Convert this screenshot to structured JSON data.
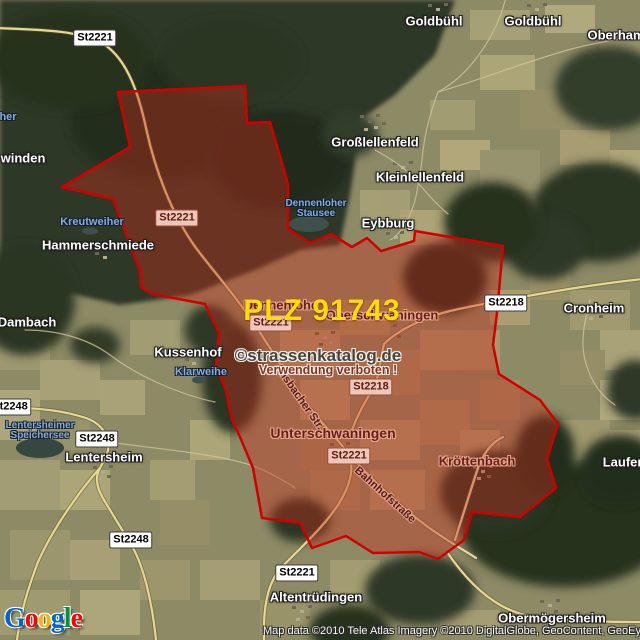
{
  "overlay": {
    "plz_text": "PLZ 91743"
  },
  "watermark": {
    "line1": "©strassenkatalog.de",
    "line2": "Verwendung verboten !"
  },
  "attribution": {
    "text": "Map data ©2010 Tele Atlas  Imagery ©2010 DigitalGlobe, GeoContent, GeoEye"
  },
  "logo": {
    "name": "Google",
    "letters": [
      "G",
      "o",
      "o",
      "g",
      "l",
      "e"
    ]
  },
  "colors": {
    "plz_text": "#FFDE00",
    "region_border": "#D10000",
    "region_fill": "rgba(200,45,28,0.40)",
    "shield_pink_bg": "#F0C6BA",
    "water_label": "#85ABDC",
    "google_blue": "#0266C8",
    "google_red": "#F90101",
    "google_yellow": "#F2B50F",
    "google_green": "#00933B"
  },
  "labels": {
    "towns": [
      {
        "text": "Goldbühl"
      },
      {
        "text": "Goldbühl"
      },
      {
        "text": "Oberhamb"
      },
      {
        "text": "winden"
      },
      {
        "text": "Großlellenfeld"
      },
      {
        "text": "Kleinlellenfeld"
      },
      {
        "text": "Eybburg"
      },
      {
        "text": "Hammerschmiede"
      },
      {
        "text": "Dambach"
      },
      {
        "text": "Kussenhof"
      },
      {
        "text": "Lentersheim"
      },
      {
        "text": "Cronheim"
      },
      {
        "text": "Laufenb"
      },
      {
        "text": "Altentrüdingen"
      },
      {
        "text": "Obermögersheim"
      }
    ],
    "towns_red": [
      {
        "text": "Dennenlohe"
      },
      {
        "text": "Oberschwaningen"
      },
      {
        "text": "Unterschwaningen"
      },
      {
        "text": "Kröttenbach"
      }
    ],
    "water": [
      {
        "text": "Kreutweiher"
      },
      {
        "text": "Klarweihe"
      },
      {
        "line1": "Dennenloher",
        "line2": "Stausee"
      },
      {
        "line1": "Lentersheimer",
        "line2": "Speichersee"
      },
      {
        "text": "her"
      }
    ],
    "shields": [
      {
        "text": "St2221"
      },
      {
        "text": "St2221"
      },
      {
        "text": "St2221"
      },
      {
        "text": "St2221"
      },
      {
        "text": "St2221"
      },
      {
        "text": "St2218"
      },
      {
        "text": "St2218"
      },
      {
        "text": "St2248"
      },
      {
        "text": "St2248"
      },
      {
        "text": "St2248"
      }
    ],
    "streets": [
      {
        "text": "Bahnhofstraße"
      },
      {
        "text": "Ansbacher Str."
      }
    ]
  }
}
